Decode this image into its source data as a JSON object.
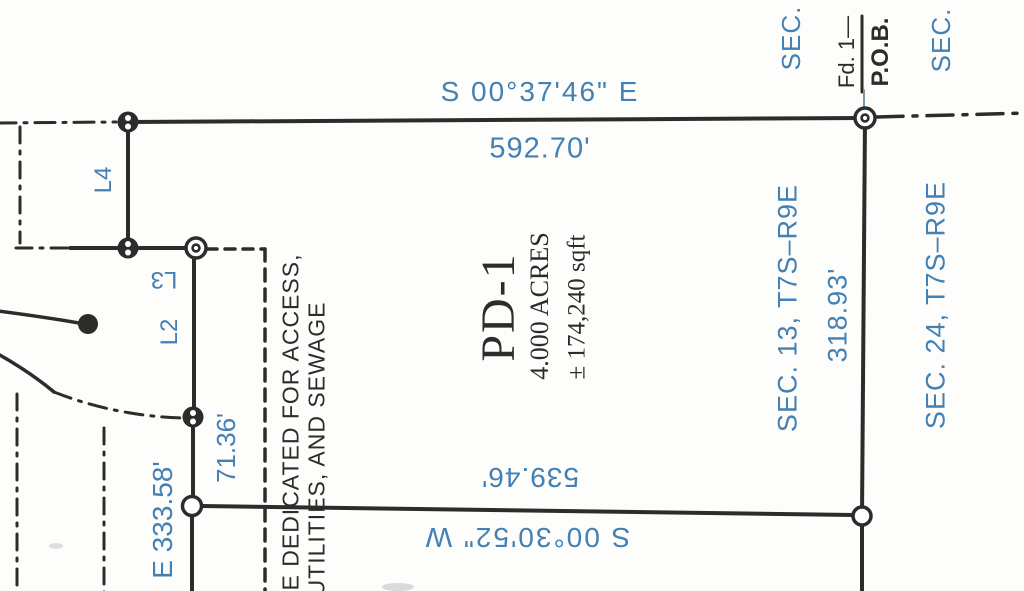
{
  "colors": {
    "annotation_blue": "#4380b4",
    "ink_black": "#2d2c2a",
    "paper": "#fdfdfc"
  },
  "parcel": {
    "name": "PD-1",
    "area_acres": "4.000 ACRES",
    "area_sqft": "± 174,240 sqft"
  },
  "boundaries": {
    "north": {
      "bearing": "S 00°37'46\" E",
      "distance": "592.70'"
    },
    "south": {
      "bearing": "S 00°30'52\" W",
      "distance": "539.46'"
    },
    "east": {
      "distance": "318.93'"
    },
    "west_segments": {
      "l4": "L4",
      "l3": "L3",
      "l2": "L2",
      "seg_71": "71.36'",
      "seg_333": "E 333.58'"
    }
  },
  "sections": {
    "top_left": "SEC.",
    "top_right": "SEC.",
    "west_of_line": "SEC. 13, T7S–R9E",
    "east_of_line": "SEC. 24, T7S–R9E"
  },
  "corner_labels": {
    "found_marker": "Fd. 1—",
    "point_of_beginning": "P.O.B."
  },
  "easement_note": {
    "line1": "E DEDICATED FOR ACCESS,",
    "line2": "UTILITIES, AND SEWAGE"
  }
}
